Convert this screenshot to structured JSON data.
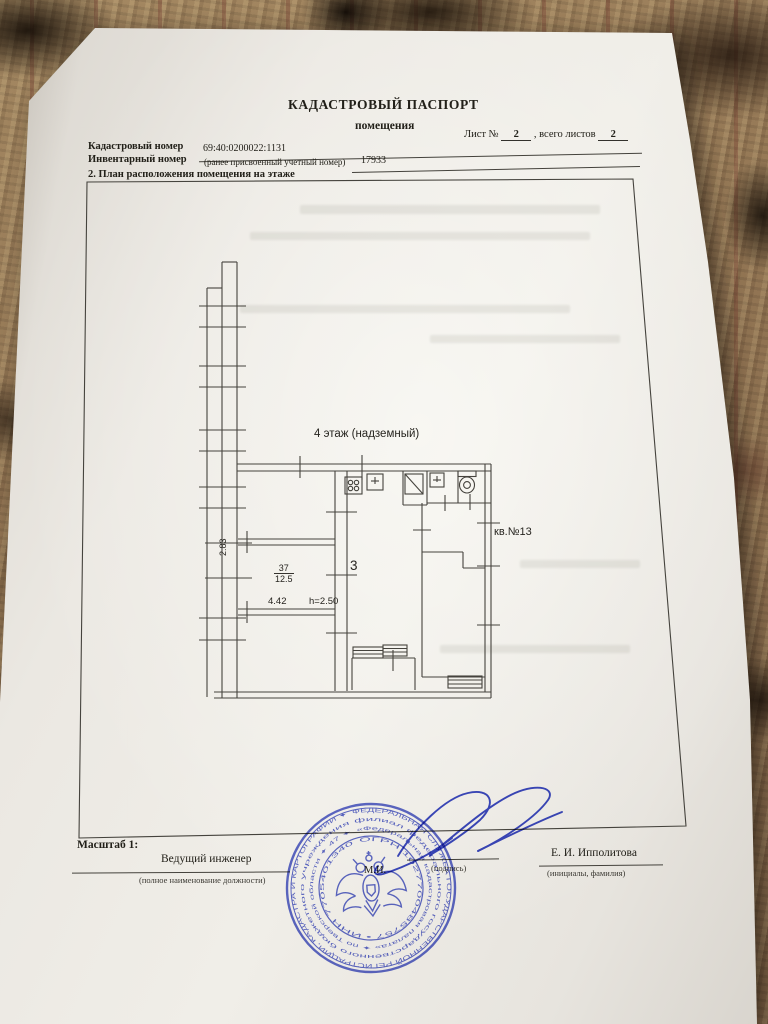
{
  "document": {
    "title": "КАДАСТРОВЫЙ ПАСПОРТ",
    "subtitle": "помещения",
    "sheet_prefix": "Лист №",
    "sheet_number": "2",
    "sheet_middle": ",  всего листов",
    "sheet_total": "2",
    "fields": {
      "cadastral_label": "Кадастровый номер",
      "cadastral_value": "69:40:0200022:1131",
      "inventory_label": "Инвентарный номер",
      "inventory_note": "(ранее присвоенный учетный номер)",
      "inventory_value": "17933",
      "section_title": "2. План расположения помещения на этаже"
    },
    "plan": {
      "floor_label": "4 этаж (надземный)",
      "apartment_label": "кв.№13",
      "room_number": "37",
      "room_area": "12.5",
      "hall_number": "3",
      "dim_width": "4.42",
      "dim_height": "h=2.50",
      "dim_side": "2.83"
    },
    "footer": {
      "scale_label": "Масштаб 1:",
      "position": "Ведущий инженер",
      "position_note": "(полное наименование должности)",
      "stamp_mark": "М.И.",
      "signature_note": "(подпись)",
      "name": "Е. И. Ипполитова",
      "name_note": "(инициалы, фамилия)"
    },
    "stamp": {
      "ring_outer": "ФЕДЕРАЛЬНАЯ СЛУЖБА ГОСУДАРСТВЕННОЙ РЕГИСТРАЦИИ, КАДАСТРА И КАРТОГРАФИИ ✦",
      "ring_middle": "филиал федерального государственного бюджетного учреждения",
      "ring_inner": "«Федеральная кадастровая палата» ✦ по Тверской области ✦ 47 ✦",
      "ring_numbers": "ОГРН 1027700485757 • ИНН 7705401340"
    },
    "colors": {
      "stamp_blue": "#3a49c5",
      "signature_blue": "#2b3ac2",
      "plan_line": "#45433d"
    }
  }
}
